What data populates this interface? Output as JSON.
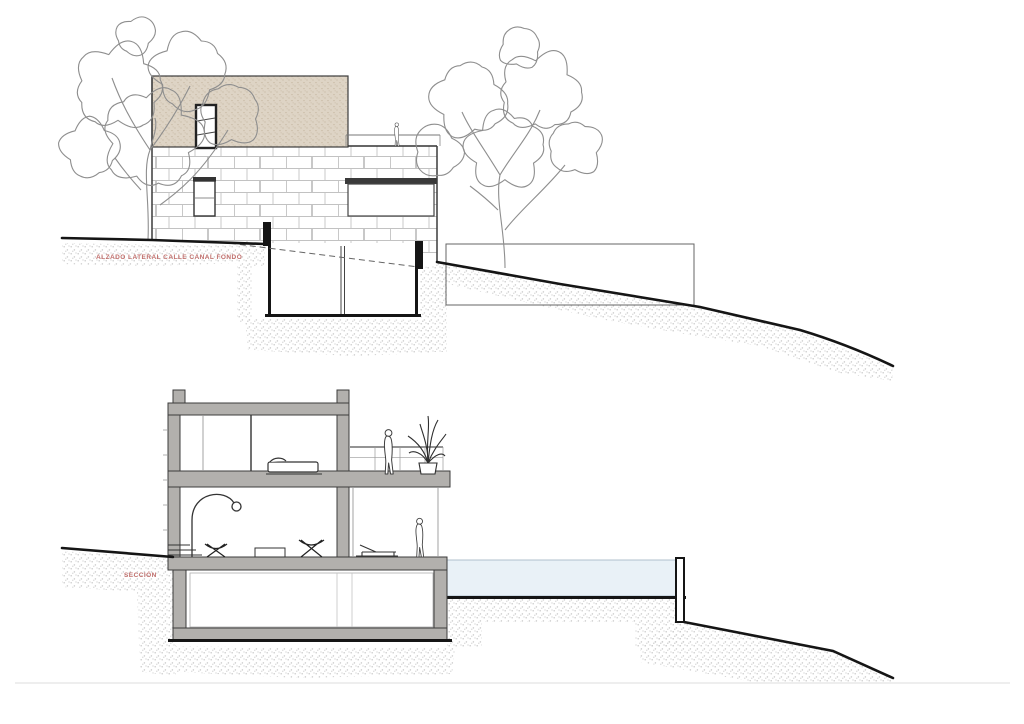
{
  "drawings": {
    "elevation": {
      "label": "ALZADO LATERAL CALLE CANAL FONDO"
    },
    "section": {
      "label": "SECCIÓN"
    }
  },
  "colors": {
    "annotation_red": "#c2706d",
    "pool_water": "#e9f1f7",
    "slab_gray": "#b2b0ad",
    "slab_edge": "#3c3c3c",
    "beige": "#ded4c5",
    "beige_dot": "#c6b8a2",
    "ground_dot": "#c9c9c9",
    "sketch_gray": "#8e8e8e",
    "brick_line": "#c2c2c2",
    "heavy_line": "#151515",
    "figure_line": "#3e3e3e",
    "glass_line": "#999999"
  }
}
